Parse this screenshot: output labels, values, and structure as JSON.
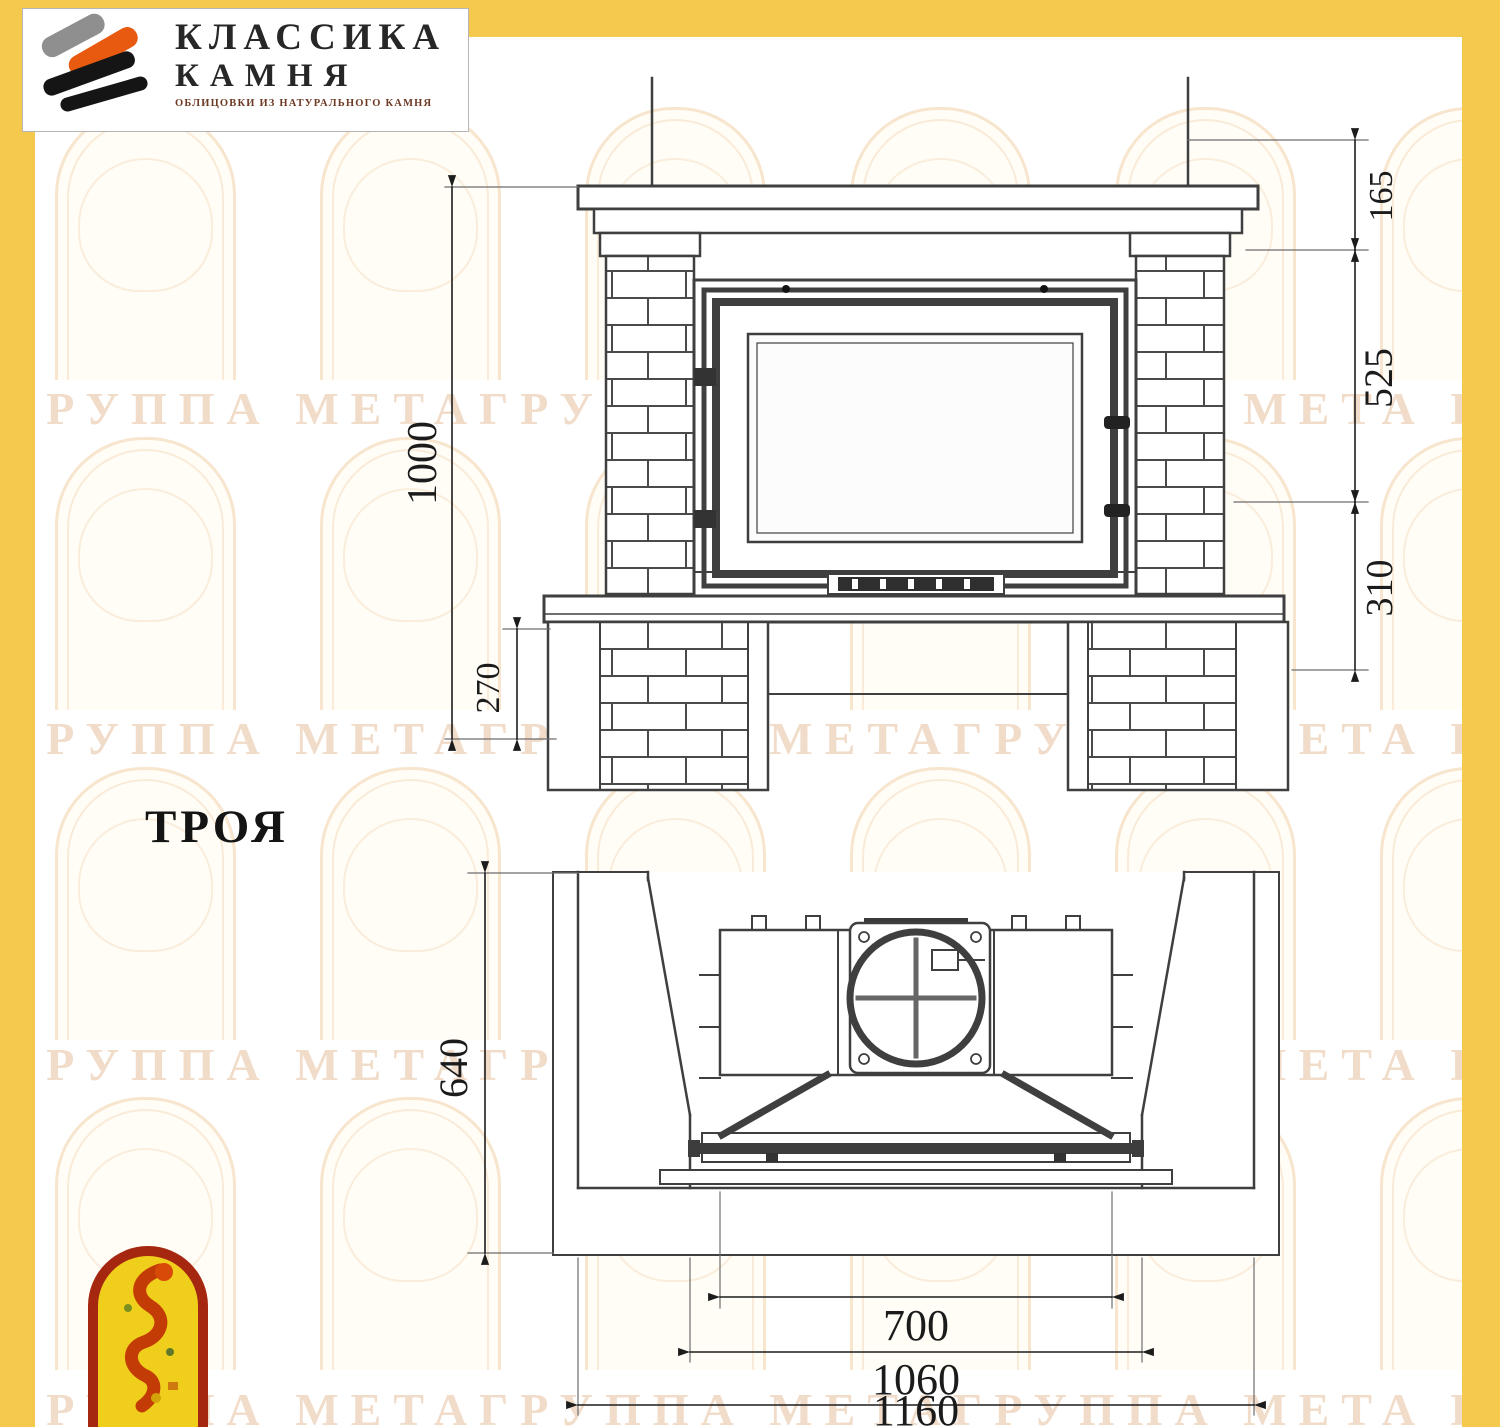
{
  "company_logo": {
    "line1": "КЛАССИКА",
    "line2": "КАМНЯ",
    "subtitle": "ОБЛИЦОВКИ ИЗ НАТУРАЛЬНОГО КАМНЯ"
  },
  "model_name": "ТРОЯ",
  "watermark_text": "ГРУППА МЕТАГРУППА МЕТАГРУППА МЕТА ГРУППА МЕТАГРУППА МЕТАГРУППА МЕТА",
  "colors": {
    "frame_yellow": "#f5c84e",
    "drawing_line": "#3f3f3f",
    "logo_orange": "#e85a10",
    "logo_gray": "#8f8f8f",
    "emblem_red": "#a5270f",
    "emblem_yellow": "#f0cf1c",
    "watermark": "#e4ba96"
  },
  "front_view": {
    "dims": {
      "total_height": "1000",
      "plinth_height": "270",
      "mantel_offset": "165",
      "firebox_height": "525",
      "base_height": "310"
    }
  },
  "top_view": {
    "dims": {
      "depth": "640",
      "firebox_width": "700",
      "inner_width": "1060",
      "overall_width": "1160"
    }
  }
}
